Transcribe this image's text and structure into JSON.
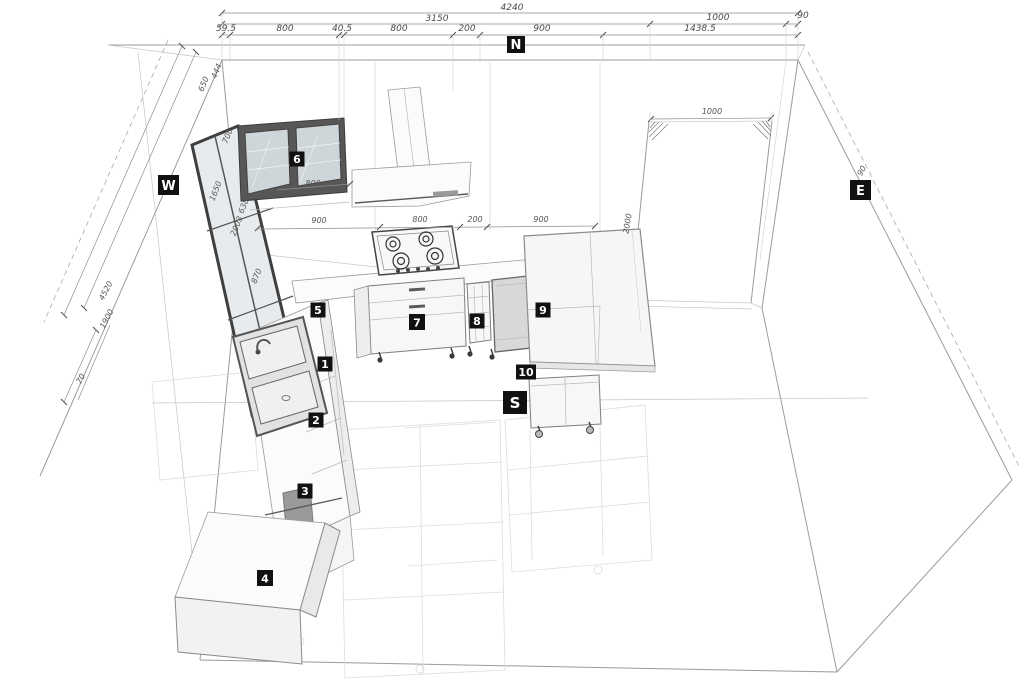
{
  "drawing": {
    "type": "kitchen-3d-plan",
    "compass": {
      "north": "N",
      "west": "W",
      "east": "E",
      "south": "S"
    },
    "item_markers": [
      "1",
      "2",
      "3",
      "4",
      "5",
      "6",
      "7",
      "8",
      "9",
      "10"
    ],
    "colors": {
      "background": "#ffffff",
      "label_bg": "#111111",
      "label_fg": "#ffffff",
      "line": "#9b9b9b",
      "dark_frame": "#3c3c3c",
      "glass": "#cfd6da",
      "dim_text": "#4a4a4a",
      "ghost": "#dcdcdc"
    }
  },
  "labels": {
    "compass": [
      {
        "text": "N"
      },
      {
        "text": "W"
      },
      {
        "text": "E"
      },
      {
        "text": "S"
      }
    ],
    "items": [
      {
        "text": "1"
      },
      {
        "text": "2"
      },
      {
        "text": "3"
      },
      {
        "text": "4"
      },
      {
        "text": "5"
      },
      {
        "text": "6"
      },
      {
        "text": "7"
      },
      {
        "text": "8"
      },
      {
        "text": "9"
      },
      {
        "text": "10"
      }
    ]
  },
  "dims": {
    "row1": [
      {
        "text": "4240"
      }
    ],
    "row2": [
      {
        "text": "3150"
      },
      {
        "text": "1000"
      },
      {
        "text": "90"
      }
    ],
    "row3": [
      {
        "text": "59.5"
      },
      {
        "text": "800"
      },
      {
        "text": "40.5"
      },
      {
        "text": "800"
      },
      {
        "text": "200"
      },
      {
        "text": "900"
      },
      {
        "text": "1438.5"
      }
    ],
    "counter": [
      {
        "text": "900"
      },
      {
        "text": "800"
      },
      {
        "text": "200"
      },
      {
        "text": "900"
      }
    ],
    "misc": [
      {
        "text": "800"
      },
      {
        "text": "1000"
      },
      {
        "text": "2000"
      },
      {
        "text": "90"
      }
    ],
    "west": [
      {
        "text": "650"
      },
      {
        "text": "444"
      },
      {
        "text": "700"
      },
      {
        "text": "1650"
      },
      {
        "text": "638"
      },
      {
        "text": "2003"
      },
      {
        "text": "870"
      },
      {
        "text": "4520"
      },
      {
        "text": "1900"
      },
      {
        "text": "70"
      }
    ]
  }
}
